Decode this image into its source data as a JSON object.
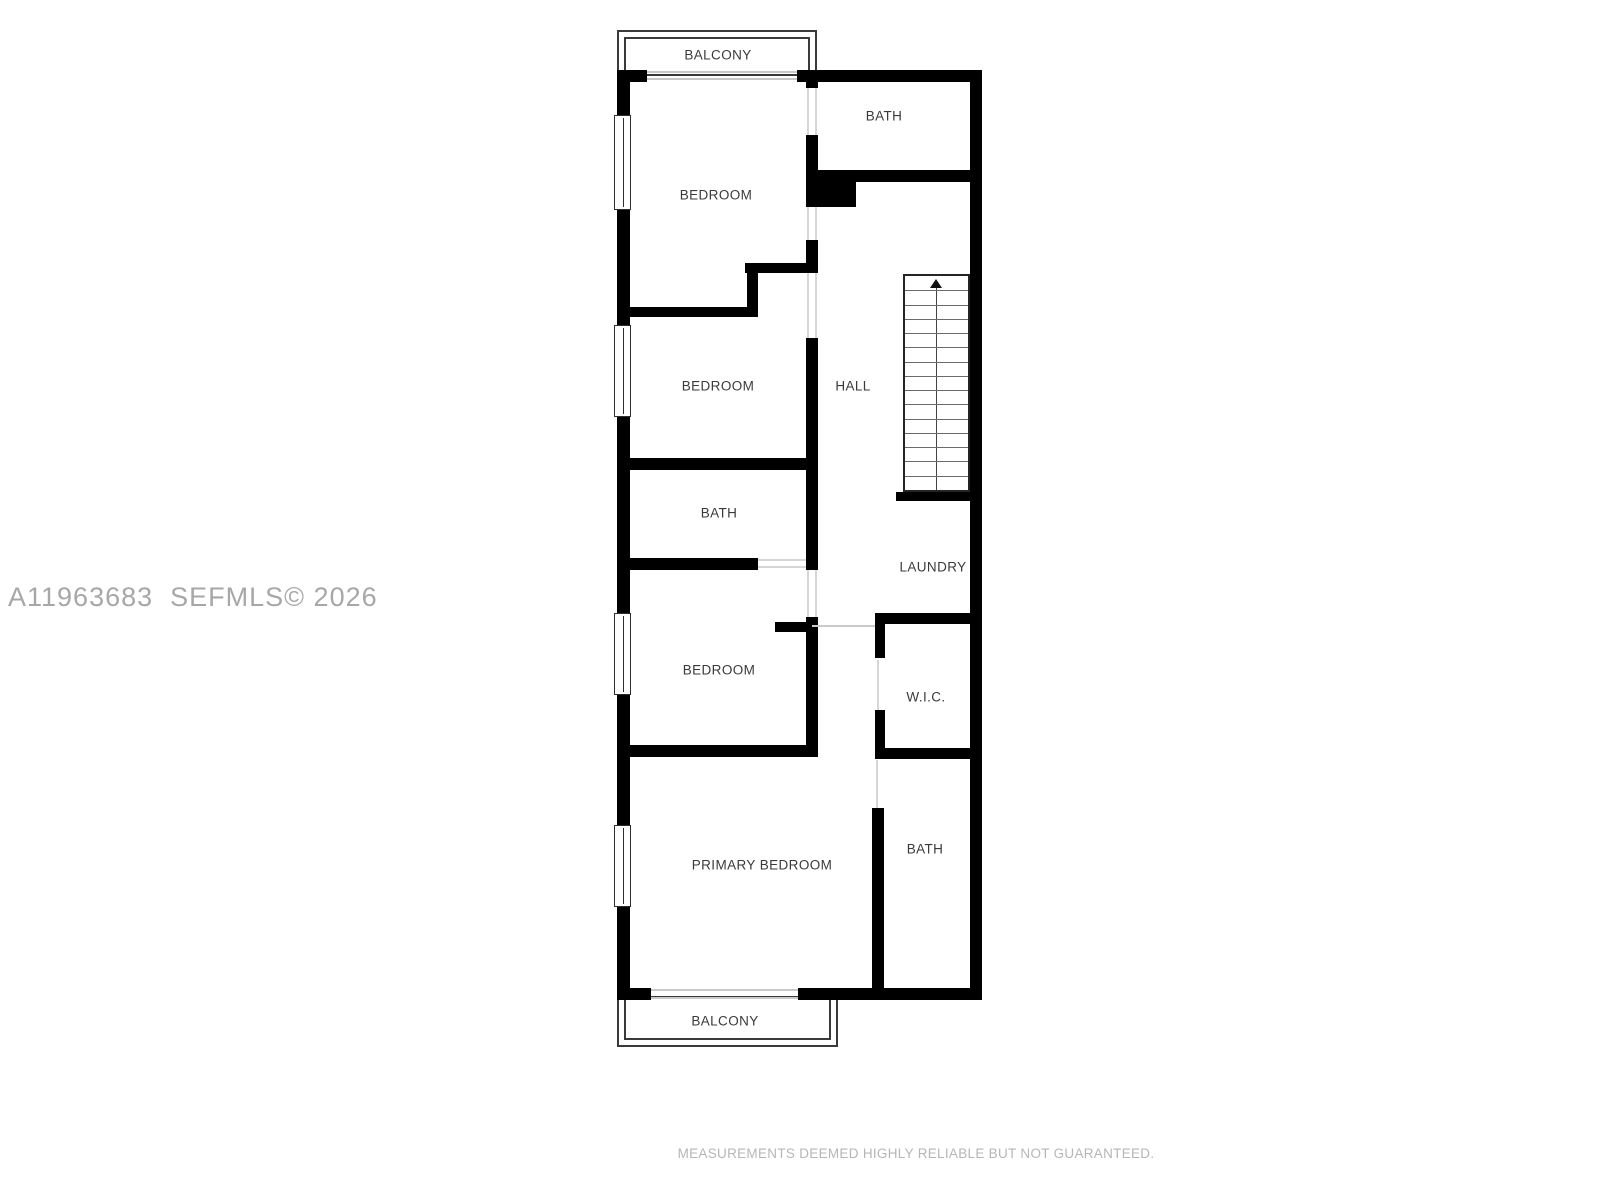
{
  "floor_plan": {
    "rooms": {
      "balcony_top": "BALCONY",
      "bedroom_top": "BEDROOM",
      "bath_top": "BATH",
      "hall": "HALL",
      "bedroom_mid": "BEDROOM",
      "bath_mid": "BATH",
      "laundry": "LAUNDRY",
      "bedroom_lower": "BEDROOM",
      "wic": "W.I.C.",
      "primary_bedroom": "PRIMARY BEDROOM",
      "bath_primary": "BATH",
      "balcony_bottom": "BALCONY"
    },
    "stairs": {
      "treads": 15,
      "direction": "up"
    }
  },
  "watermark": "A11963683  SEFMLS© 2026",
  "disclaimer": "MEASUREMENTS DEEMED HIGHLY RELIABLE BUT NOT GUARANTEED.",
  "colors": {
    "wall": "#000000",
    "label": "#3a3a3a",
    "watermark": "#a7a7a7",
    "disclaimer": "#b6b6b6"
  }
}
